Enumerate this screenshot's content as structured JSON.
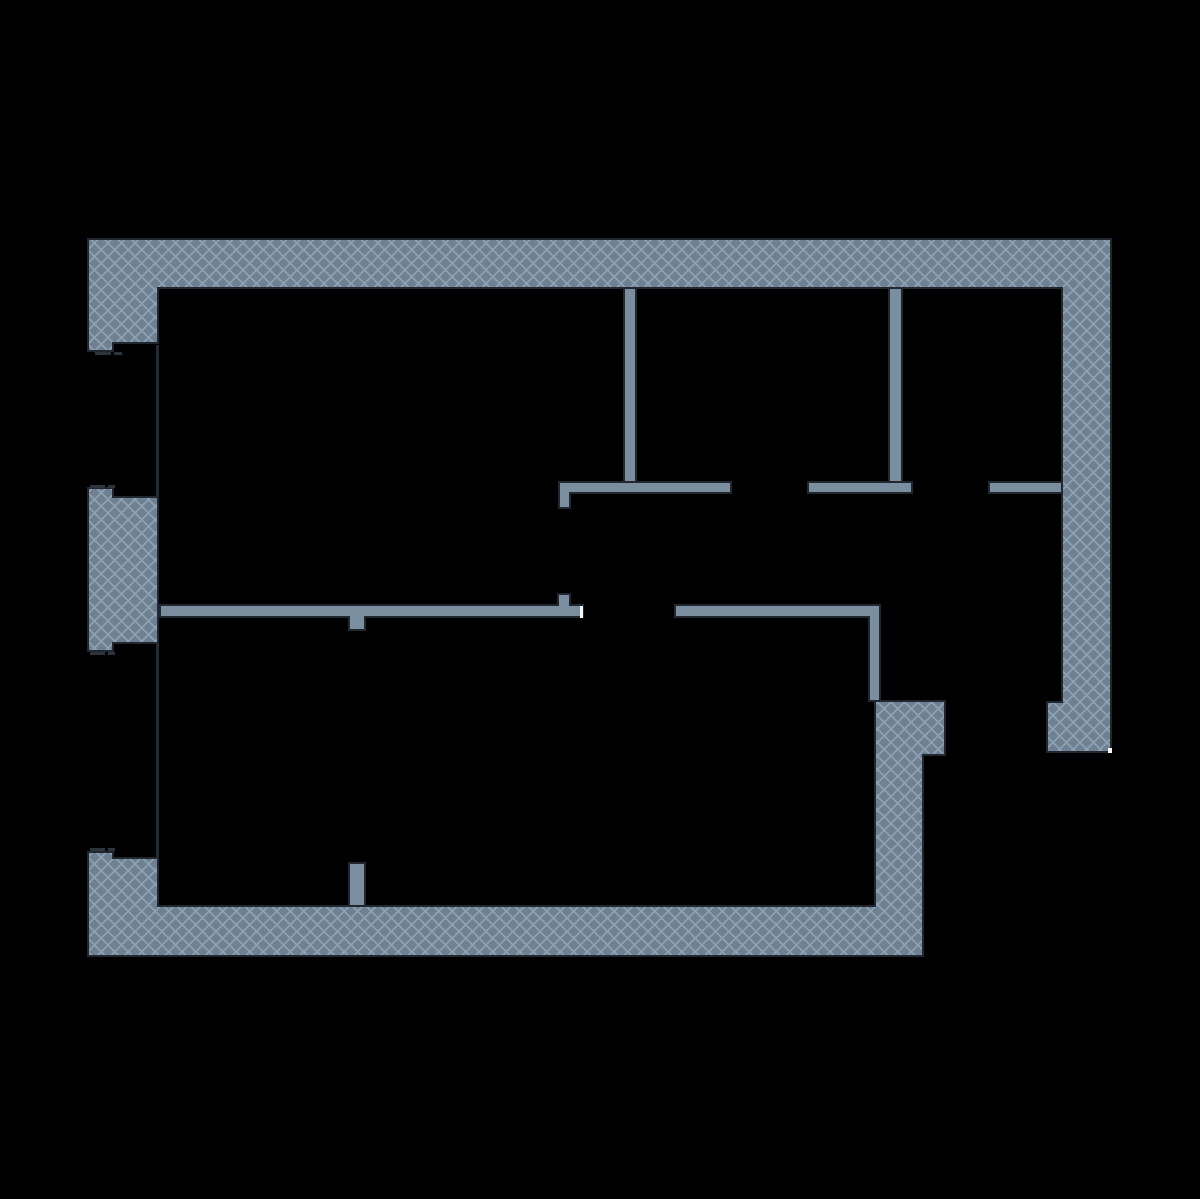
{
  "canvas": {
    "width": 1200,
    "height": 1199,
    "background": "#000000"
  },
  "palette": {
    "wall_base": "#6e8091",
    "hatch_line": "#8ea3b4",
    "partition_fill": "#7b8ea0",
    "outline": "#20272e",
    "white_mark": "#f4f6f8",
    "faint_edge": "#242b33",
    "window_dash": "#2c343c"
  },
  "hatch_pattern": {
    "tile": 13.5,
    "line_width": 1.7,
    "opacity": 0.95
  },
  "outline_width": 2,
  "walls": {
    "exterior_hatched": [
      {
        "name": "wall-exterior-top-right",
        "points": [
          [
            88,
            239
          ],
          [
            1111,
            239
          ],
          [
            1111,
            752
          ],
          [
            1047,
            752
          ],
          [
            1047,
            702
          ],
          [
            1062,
            702
          ],
          [
            1062,
            288
          ],
          [
            158,
            288
          ],
          [
            158,
            343
          ],
          [
            113,
            343
          ],
          [
            113,
            351
          ],
          [
            88,
            351
          ]
        ]
      },
      {
        "name": "wall-exterior-left-middle-pier",
        "points": [
          [
            88,
            488
          ],
          [
            113,
            488
          ],
          [
            113,
            497
          ],
          [
            158,
            497
          ],
          [
            158,
            643
          ],
          [
            113,
            643
          ],
          [
            113,
            651
          ],
          [
            88,
            651
          ]
        ]
      },
      {
        "name": "wall-exterior-bottom",
        "points": [
          [
            88,
            852
          ],
          [
            113,
            852
          ],
          [
            113,
            858
          ],
          [
            158,
            858
          ],
          [
            158,
            906
          ],
          [
            875,
            906
          ],
          [
            875,
            701
          ],
          [
            945,
            701
          ],
          [
            945,
            755
          ],
          [
            923,
            755
          ],
          [
            923,
            956
          ],
          [
            88,
            956
          ]
        ]
      }
    ],
    "interior_partitions": [
      {
        "name": "partition-vertical-left",
        "rect": [
          624,
          288,
          12,
          194
        ]
      },
      {
        "name": "partition-vertical-right",
        "rect": [
          889,
          288,
          13,
          194
        ]
      },
      {
        "name": "partition-upper-left",
        "points": [
          [
            559,
            482
          ],
          [
            731,
            482
          ],
          [
            731,
            493
          ],
          [
            570,
            493
          ],
          [
            570,
            508
          ],
          [
            559,
            508
          ]
        ]
      },
      {
        "name": "partition-upper-middle",
        "rect": [
          808,
          482,
          104,
          11
        ]
      },
      {
        "name": "partition-upper-right",
        "rect": [
          989,
          482,
          73,
          11
        ]
      },
      {
        "name": "partition-lower-left",
        "points": [
          [
            160,
            605
          ],
          [
            558,
            605
          ],
          [
            558,
            594
          ],
          [
            570,
            594
          ],
          [
            570,
            605
          ],
          [
            583,
            605
          ],
          [
            583,
            617
          ],
          [
            365,
            617
          ],
          [
            365,
            630
          ],
          [
            349,
            630
          ],
          [
            349,
            617
          ],
          [
            160,
            617
          ]
        ]
      },
      {
        "name": "partition-lower-right",
        "points": [
          [
            675,
            605
          ],
          [
            880,
            605
          ],
          [
            880,
            701
          ],
          [
            869,
            701
          ],
          [
            869,
            617
          ],
          [
            675,
            617
          ]
        ]
      },
      {
        "name": "partition-bottom-door-stub",
        "rect": [
          349,
          863,
          16,
          43
        ]
      }
    ]
  },
  "details": {
    "white_marks": [
      {
        "name": "door-end-cap-mark",
        "rect": [
          580,
          606,
          3,
          12
        ]
      },
      {
        "name": "right-wall-bottom-tick",
        "rect": [
          1108,
          748,
          4,
          5
        ]
      }
    ],
    "window_edges": [
      {
        "name": "window-face-upper",
        "rect": [
          156,
          345,
          3,
          152
        ]
      },
      {
        "name": "window-face-lower",
        "rect": [
          156,
          643,
          3,
          215
        ]
      }
    ],
    "window_dashes": [
      {
        "rect": [
          95,
          352,
          16,
          3
        ]
      },
      {
        "rect": [
          114,
          352,
          8,
          3
        ]
      },
      {
        "rect": [
          90,
          485,
          15,
          3
        ]
      },
      {
        "rect": [
          108,
          485,
          7,
          3
        ]
      },
      {
        "rect": [
          90,
          652,
          15,
          3
        ]
      },
      {
        "rect": [
          108,
          652,
          7,
          3
        ]
      },
      {
        "rect": [
          90,
          848,
          15,
          3
        ]
      },
      {
        "rect": [
          108,
          848,
          7,
          3
        ]
      }
    ]
  }
}
